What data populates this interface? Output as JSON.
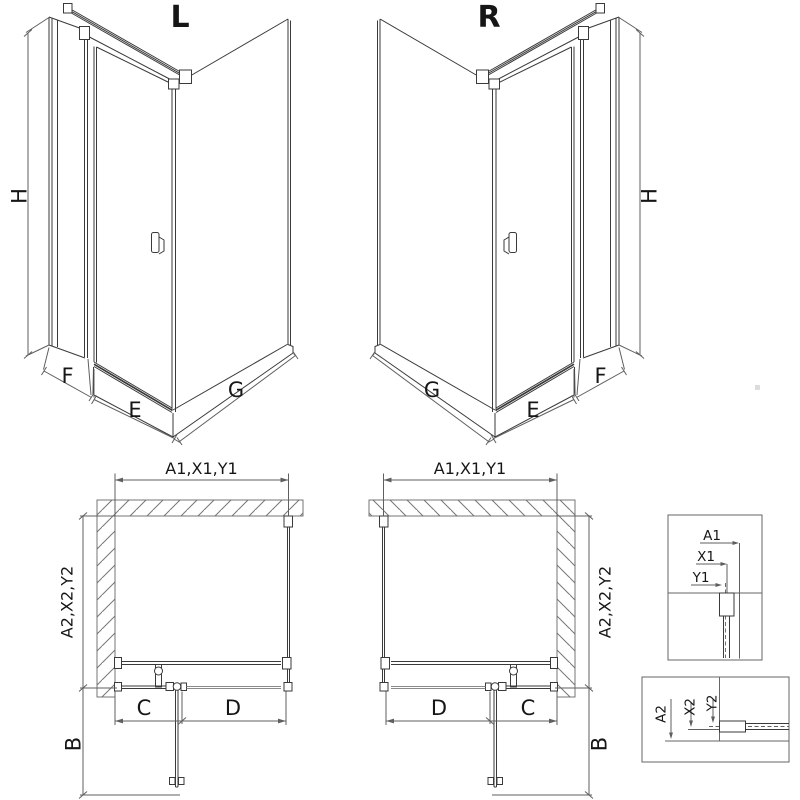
{
  "title": "Corner shower enclosure technical dimension diagram, left (L) and right (R) door versions",
  "views3d": {
    "left": {
      "label": "L",
      "height_dim": "H",
      "panel_dim": "F",
      "door_dim": "E",
      "side_dim": "G"
    },
    "right": {
      "label": "R",
      "height_dim": "H",
      "panel_dim": "F",
      "door_dim": "E",
      "side_dim": "G"
    }
  },
  "plans": {
    "left": {
      "width_dim": "A1,X1,Y1",
      "depth_dim": "A2,X2,Y2",
      "fixed_dim": "C",
      "door_dim": "D",
      "swing_dim": "B"
    },
    "right": {
      "width_dim": "A1,X1,Y1",
      "depth_dim": "A2,X2,Y2",
      "fixed_dim": "C",
      "door_dim": "D",
      "swing_dim": "B"
    }
  },
  "details": {
    "top": {
      "labels": [
        "A1",
        "X1",
        "Y1"
      ]
    },
    "bottom": {
      "labels": [
        "A2",
        "X2",
        "Y2"
      ]
    }
  }
}
